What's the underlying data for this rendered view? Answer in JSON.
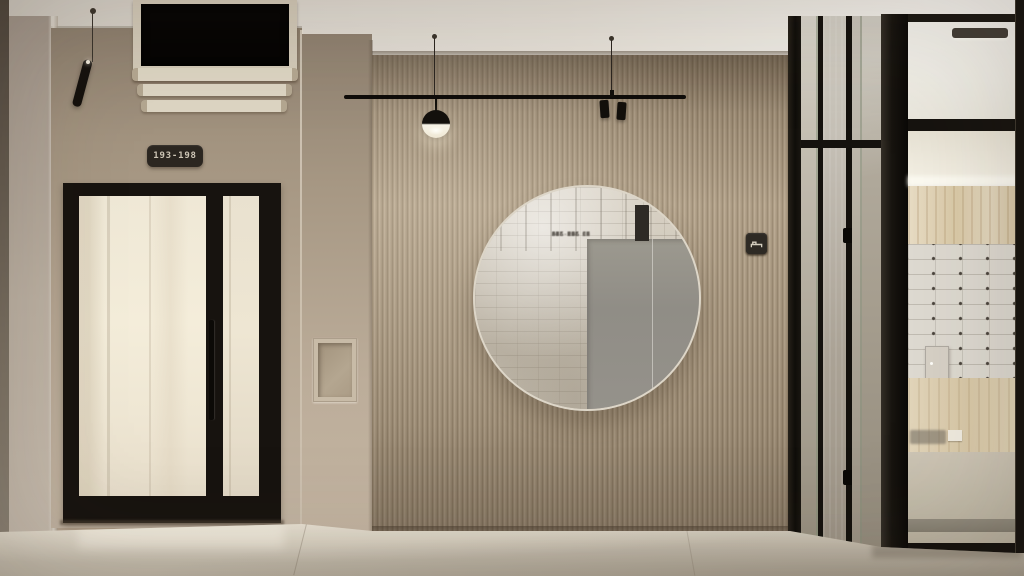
{
  "scene": {
    "title": "Residential lobby interior render",
    "description": "Minimalist beige lobby: glass entrance door with unit-range plaque, fluted wood-slat wall with suspended track light and round mirror, wayfinding pictogram signs, and a glass-walled safe-deposit-box room"
  },
  "door_sign": {
    "label": "193-198"
  },
  "wayfinding": {
    "tiles": [
      {
        "icon": "stairs-icon"
      },
      {
        "icon": "arrow-right-icon"
      },
      {
        "icon": "arrow-left-icon"
      },
      {
        "icon": "bench-icon"
      }
    ]
  },
  "mirror": {
    "note_rows_are_mirrored_reflection": true,
    "directory_rows": [
      "310-345",
      "346-352",
      "353-360",
      "361-368",
      "369-376",
      "377-384",
      "385-392",
      "393-400",
      "401-408",
      "409-416",
      "417-424",
      "425-432",
      "433-440"
    ],
    "code_rows": [
      "8",
      "5",
      "7",
      "4",
      "1",
      "9",
      "01",
      "11",
      "31",
      "05",
      "81",
      "12",
      "10"
    ]
  },
  "palette": {
    "wall_beige": "#b3a28d",
    "fluted_wood": "#ac9b83",
    "frame_black": "#17130f",
    "ceiling_cream": "#e9e5dd",
    "floor_light": "#cfc8ba",
    "glass_warm": "#f0e9d7",
    "sign_background": "#2b2620",
    "sign_text": "#cdc5b5",
    "lamp_glow": "#f8f4e7"
  }
}
